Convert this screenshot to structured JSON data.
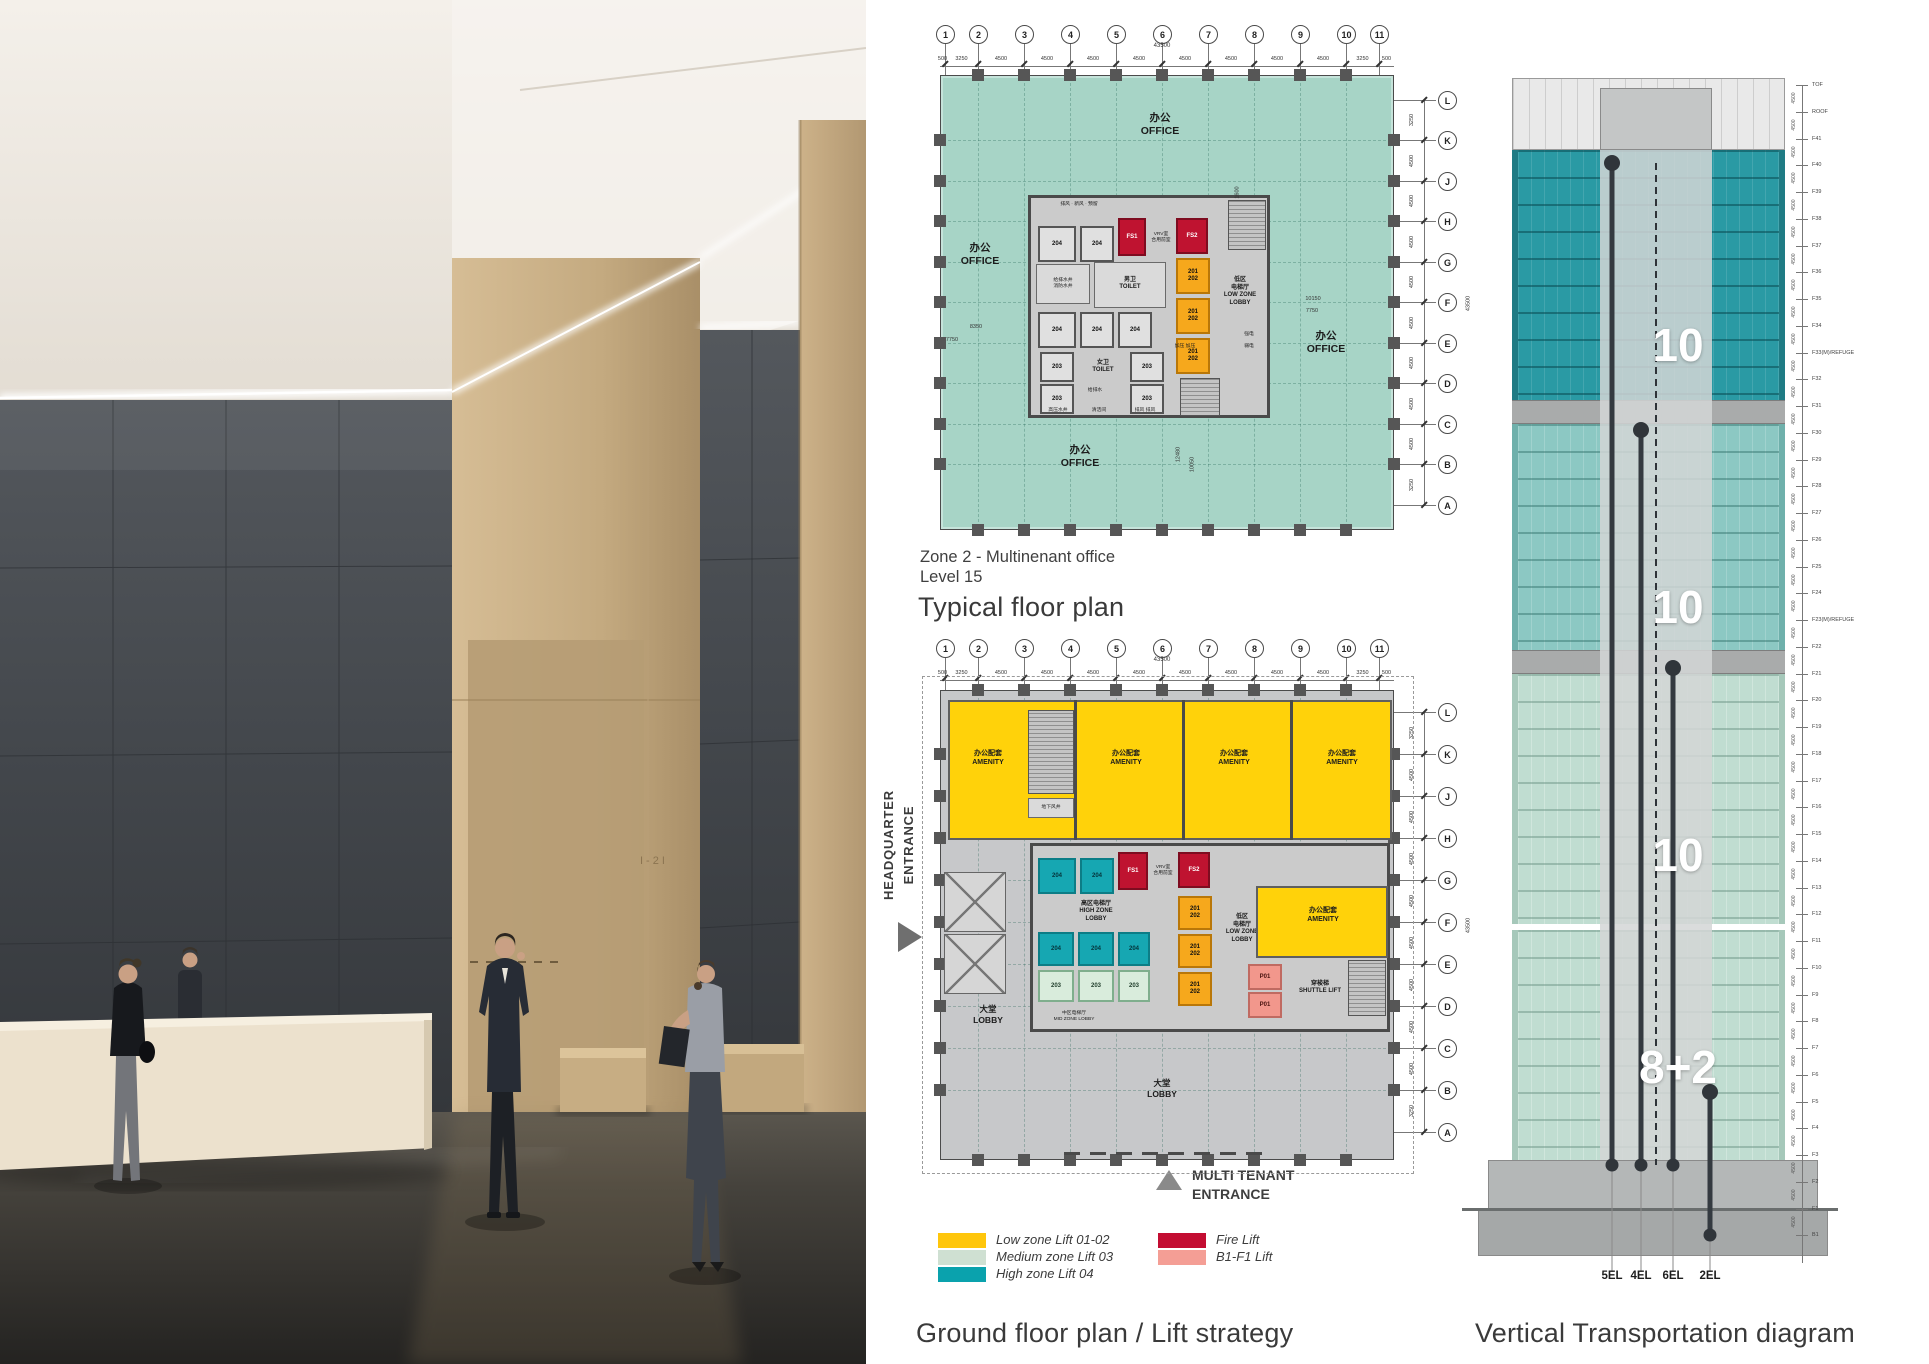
{
  "photo": {
    "wall_sign": "I-2I"
  },
  "typical_plan": {
    "caption": [
      "Zone 2 - Multinenant office",
      "Level 15"
    ],
    "title": "Typical floor plan",
    "grid_numbers": [
      "1",
      "2",
      "3",
      "4",
      "5",
      "6",
      "7",
      "8",
      "9",
      "10",
      "11"
    ],
    "grid_letters": [
      "L",
      "K",
      "J",
      "H",
      "G",
      "F",
      "E",
      "D",
      "C",
      "B",
      "A"
    ],
    "top_dims": [
      "500",
      "3250",
      "4500",
      "4500",
      "4500",
      "4500",
      "4500",
      "4500",
      "4500",
      "4500",
      "3250",
      "500"
    ],
    "side_dims": [
      "3250",
      "4500",
      "4500",
      "4500",
      "4500",
      "4500",
      "4500",
      "4500",
      "4500",
      "3250"
    ],
    "overall_dim": "43500",
    "side_overall_dim": "43500",
    "dims_floating": [
      "8350",
      "7750",
      "10150",
      "7750",
      "1600",
      "12480",
      "10050"
    ],
    "rooms": {
      "office": "办公\nOFFICE",
      "vents": "排风 · 新风 · 预留",
      "vrv": "VRV室\n合用前室",
      "toilet_m": "男卫\nTOILET",
      "toilet_f": "女卫\nTOILET",
      "shafts": "给排水井\n消防水井",
      "low_lobby": "低区\n电梯厅\nLOW ZONE\nLOBBY",
      "drain": "给排水",
      "hp": "高压水井",
      "clean": "清洁间",
      "vents2": "排风 排风",
      "press": "加压 加压",
      "elec_s": "强电",
      "elec_w": "弱电",
      "l204": "204",
      "l203": "203",
      "l2012": "201\n202",
      "fs1": "FS1",
      "fs2": "FS2"
    }
  },
  "ground_plan": {
    "title": "Ground floor plan / Lift strategy",
    "entrance_left": [
      "HEADQUARTER",
      "ENTRANCE"
    ],
    "entrance_bottom": "MULTI TENANT\nENTRANCE",
    "rooms": {
      "amenity": "办公配套\nAMENITY",
      "lobby": "大堂\nLOBBY",
      "high_lobby": "高区电梯厅\nHIGH ZONE\nLOBBY",
      "mid_lobby": "中区电梯厅\nMID ZONE LOBBY",
      "low_lobby": "低区\n电梯厅\nLOW ZONE\nLOBBY",
      "shuttle": "穿梭梯\nSHUTTLE LIFT",
      "underground": "地下风井",
      "vrv": "VRV室\n合用前室",
      "l204": "204",
      "l203": "203",
      "l2012": "201\n202",
      "p01": "P01",
      "fs1": "FS1",
      "fs2": "FS2"
    }
  },
  "legend": {
    "items": [
      {
        "label": "Low zone Lift 01-02",
        "color": "#FFC60B"
      },
      {
        "label": "Medium zone Lift 03",
        "color": "#CFE0D2"
      },
      {
        "label": "High zone Lift 04",
        "color": "#0AA2AD"
      },
      {
        "label": "Fire Lift",
        "color": "#C30D32"
      },
      {
        "label": "B1-F1 Lift",
        "color": "#F49E95"
      }
    ]
  },
  "tower": {
    "title": "Vertical Transportation diagram",
    "zone_counts": [
      "10",
      "10",
      "10",
      "8+2"
    ],
    "shaft_labels": [
      "5EL",
      "4EL",
      "6EL",
      "2EL"
    ],
    "floor_dim": "4500",
    "floors": [
      "TOF",
      "ROOF",
      "F41",
      "F40",
      "F39",
      "F38",
      "F37",
      "F36",
      "F35",
      "F34",
      "F33(M)/REFUGE",
      "F32",
      "F31",
      "F30",
      "F29",
      "F28",
      "F27",
      "F26",
      "F25",
      "F24",
      "F23(M)/REFUGE",
      "F22",
      "F21",
      "F20",
      "F19",
      "F18",
      "F17",
      "F16",
      "F15",
      "F14",
      "F13",
      "F12",
      "F11",
      "F10",
      "F9",
      "F8",
      "F7",
      "F6",
      "F5",
      "F4",
      "F3",
      "F2",
      "F1",
      "B1"
    ]
  }
}
